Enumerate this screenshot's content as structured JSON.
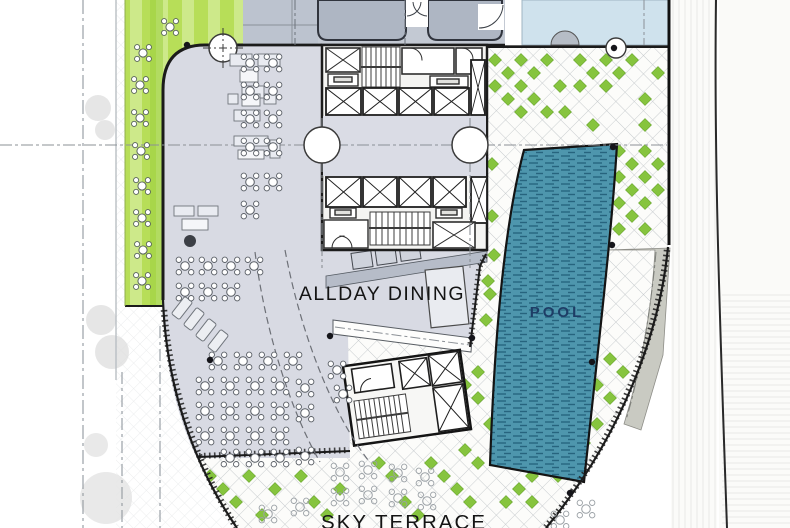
{
  "labels": {
    "all_day_dining": "ALLDAY DINING",
    "pool": "POOL",
    "sky_terrace": "SKY TERRACE"
  },
  "colors": {
    "dining_floor": "#d8dae3",
    "lobby_floor": "#dadce5",
    "servery_band": "#b6bcc8",
    "tower_mass": "#aeb6c3",
    "tower_base": "#c3c9d3",
    "water_feature": "#cfe2ed",
    "pool_water": "#4e96ad",
    "pool_dash": "#2b6b85",
    "pool_label": "#1e3d66",
    "lawn_light": "#cde98a",
    "lawn_dark": "#b7de58",
    "paver_diamond_green": "#86c43e",
    "lattice_line": "#c6cacd",
    "plate_outline": "#1b1b1b",
    "ramp_wedge": "#c9cac2"
  },
  "furniture": {
    "dining_tables": [
      [
        250,
        63
      ],
      [
        273,
        63
      ],
      [
        250,
        91
      ],
      [
        273,
        91
      ],
      [
        250,
        119
      ],
      [
        273,
        119
      ],
      [
        250,
        147
      ],
      [
        273,
        147
      ],
      [
        250,
        182
      ],
      [
        273,
        182
      ],
      [
        250,
        210
      ],
      [
        185,
        266
      ],
      [
        208,
        266
      ],
      [
        231,
        266
      ],
      [
        254,
        266
      ],
      [
        185,
        292
      ],
      [
        208,
        292
      ],
      [
        231,
        292
      ],
      [
        337,
        370
      ],
      [
        343,
        394
      ],
      [
        218,
        361
      ],
      [
        243,
        361
      ],
      [
        268,
        361
      ],
      [
        293,
        361
      ],
      [
        205,
        386
      ],
      [
        230,
        386
      ],
      [
        255,
        386
      ],
      [
        280,
        386
      ],
      [
        305,
        388
      ],
      [
        205,
        411
      ],
      [
        230,
        411
      ],
      [
        255,
        411
      ],
      [
        280,
        411
      ],
      [
        305,
        413
      ],
      [
        205,
        436
      ],
      [
        230,
        436
      ],
      [
        255,
        436
      ],
      [
        280,
        436
      ],
      [
        230,
        458
      ],
      [
        255,
        458
      ],
      [
        280,
        458
      ],
      [
        305,
        456
      ]
    ],
    "garden_tables": [
      [
        170,
        27
      ],
      [
        143,
        53
      ],
      [
        140,
        85
      ],
      [
        140,
        118
      ],
      [
        141,
        151
      ],
      [
        142,
        186
      ],
      [
        142,
        218
      ],
      [
        143,
        250
      ],
      [
        142,
        281
      ]
    ],
    "ghost_tables": [
      [
        340,
        472
      ],
      [
        368,
        470
      ],
      [
        398,
        473
      ],
      [
        425,
        477
      ],
      [
        340,
        497
      ],
      [
        368,
        495
      ],
      [
        398,
        498
      ],
      [
        300,
        507
      ],
      [
        268,
        514
      ],
      [
        427,
        501
      ],
      [
        560,
        520
      ],
      [
        586,
        509
      ]
    ],
    "lounge_chairs": [
      [
        182,
        308
      ],
      [
        194,
        319
      ],
      [
        206,
        330
      ],
      [
        218,
        341
      ]
    ]
  },
  "paving": {
    "green_diamonds": [
      [
        495,
        60
      ],
      [
        508,
        73
      ],
      [
        521,
        60
      ],
      [
        495,
        86
      ],
      [
        521,
        86
      ],
      [
        534,
        73
      ],
      [
        508,
        99
      ],
      [
        534,
        99
      ],
      [
        547,
        60
      ],
      [
        521,
        112
      ],
      [
        547,
        112
      ],
      [
        560,
        86
      ],
      [
        580,
        60
      ],
      [
        593,
        73
      ],
      [
        606,
        60
      ],
      [
        580,
        86
      ],
      [
        606,
        86
      ],
      [
        619,
        73
      ],
      [
        632,
        60
      ],
      [
        645,
        99
      ],
      [
        658,
        73
      ],
      [
        593,
        125
      ],
      [
        565,
        112
      ],
      [
        645,
        125
      ],
      [
        619,
        151
      ],
      [
        632,
        164
      ],
      [
        645,
        151
      ],
      [
        619,
        177
      ],
      [
        645,
        177
      ],
      [
        632,
        190
      ],
      [
        619,
        203
      ],
      [
        645,
        203
      ],
      [
        632,
        216
      ],
      [
        658,
        164
      ],
      [
        658,
        190
      ],
      [
        619,
        229
      ],
      [
        645,
        229
      ],
      [
        492,
        164
      ],
      [
        492,
        216
      ],
      [
        494,
        255
      ],
      [
        490,
        294
      ],
      [
        486,
        320
      ],
      [
        488,
        281
      ],
      [
        478,
        372
      ],
      [
        465,
        385
      ],
      [
        478,
        398
      ],
      [
        490,
        424
      ],
      [
        465,
        450
      ],
      [
        478,
        463
      ],
      [
        610,
        359
      ],
      [
        623,
        372
      ],
      [
        597,
        385
      ],
      [
        610,
        398
      ],
      [
        584,
        411
      ],
      [
        597,
        424
      ],
      [
        571,
        437
      ],
      [
        558,
        450
      ],
      [
        584,
        443
      ],
      [
        545,
        463
      ],
      [
        532,
        476
      ],
      [
        558,
        476
      ],
      [
        519,
        489
      ],
      [
        506,
        502
      ],
      [
        532,
        502
      ],
      [
        210,
        476
      ],
      [
        223,
        489
      ],
      [
        236,
        502
      ],
      [
        249,
        476
      ],
      [
        262,
        515
      ],
      [
        275,
        489
      ],
      [
        301,
        476
      ],
      [
        314,
        502
      ],
      [
        327,
        515
      ],
      [
        340,
        489
      ],
      [
        379,
        463
      ],
      [
        392,
        476
      ],
      [
        405,
        502
      ],
      [
        431,
        463
      ],
      [
        444,
        476
      ],
      [
        457,
        489
      ],
      [
        418,
        515
      ],
      [
        470,
        502
      ]
    ]
  },
  "structure": {
    "column_dots": [
      [
        187,
        45
      ],
      [
        614,
        48
      ],
      [
        613,
        147
      ],
      [
        612,
        245
      ],
      [
        330,
        336
      ],
      [
        472,
        338
      ],
      [
        592,
        362
      ],
      [
        570,
        493
      ],
      [
        210,
        360
      ]
    ]
  }
}
